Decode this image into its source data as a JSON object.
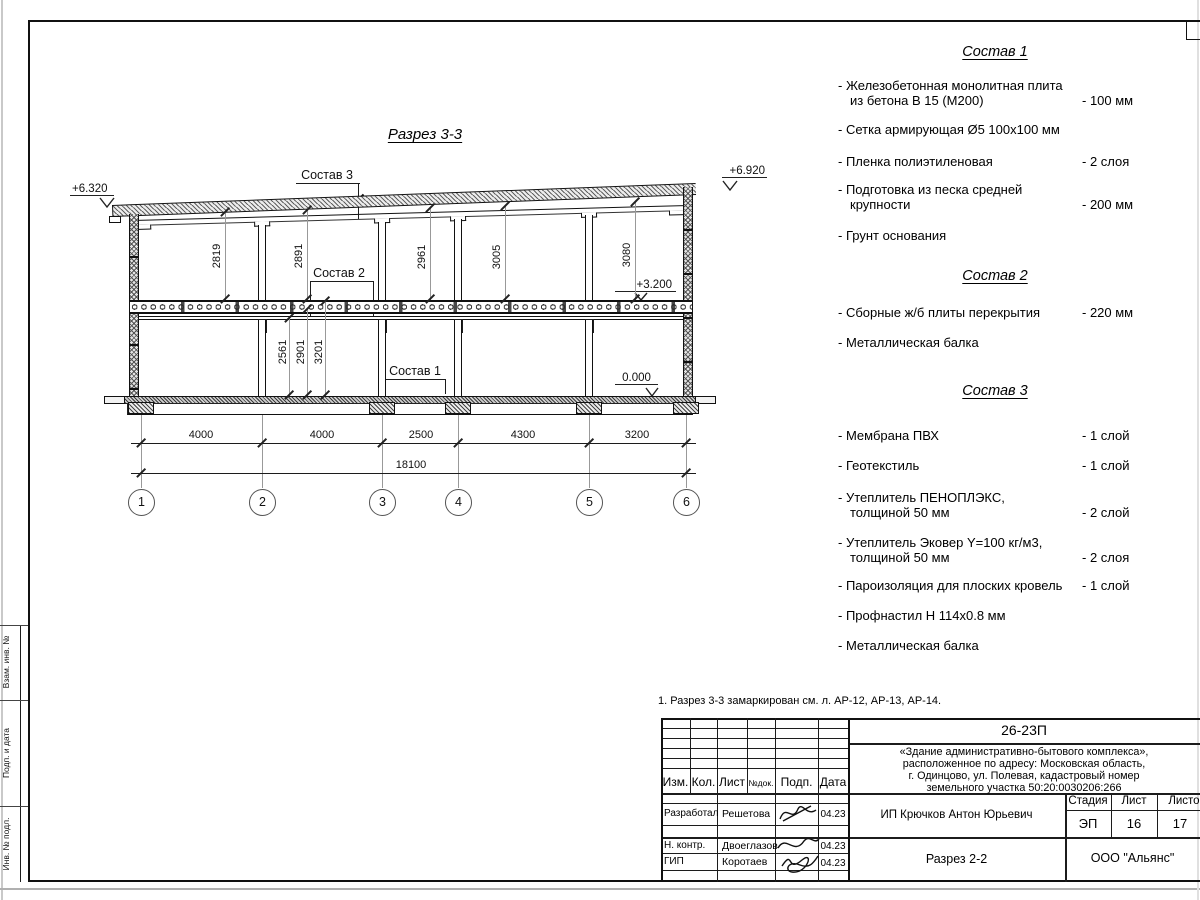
{
  "sheet": {
    "title": "Разрез 3-3",
    "note": "1. Разрез 3-3 замаркирован см. л. АР-12, АР-13, АР-14."
  },
  "section": {
    "elev_top_left": "+6.320",
    "elev_top_right": "+6.920",
    "elev_mid": "+3.200",
    "elev_zero": "0.000",
    "leader_sostav3": "Состав 3",
    "leader_sostav2": "Состав 2",
    "leader_sostav1": "Состав 1",
    "dims_upper": [
      "2819",
      "2891",
      "2961",
      "3005",
      "3080"
    ],
    "dims_lower": [
      "2561",
      "2901",
      "3201"
    ],
    "span_dims": [
      "4000",
      "4000",
      "2500",
      "4300",
      "3200"
    ],
    "total_dim": "18100",
    "axes": [
      "1",
      "2",
      "3",
      "4",
      "5",
      "6"
    ]
  },
  "specs": [
    {
      "title": "Состав 1",
      "items": [
        {
          "t1": "- Железобетонная  монолитная плита",
          "t2": "из бетона В 15 (М200)",
          "v": "- 100 мм"
        },
        {
          "t1": "- Сетка армирующая Ø5 100х100 мм"
        },
        {
          "t1": "- Пленка полиэтиленовая",
          "v": "-  2 слоя"
        },
        {
          "t1": "- Подготовка из песка средней",
          "t2": "крупности",
          "v": "- 200 мм"
        },
        {
          "t1": "- Грунт основания"
        }
      ]
    },
    {
      "title": "Состав 2",
      "items": [
        {
          "t1": "- Сборные ж/б плиты перекрытия",
          "v": "- 220 мм"
        },
        {
          "t1": "- Металлическая балка"
        }
      ]
    },
    {
      "title": "Состав 3",
      "items": [
        {
          "t1": "- Мембрана ПВХ",
          "v": "- 1 слой"
        },
        {
          "t1": "- Геотекстиль",
          "v": "- 1 слой"
        },
        {
          "t1": "- Утеплитель ПЕНОПЛЭКС,",
          "t2": "толщиной 50 мм",
          "v": "- 2 слой"
        },
        {
          "t1": "- Утеплитель Эковер Y=100 кг/м3,",
          "t2": "толщиной 50 мм",
          "v": "- 2 слоя"
        },
        {
          "t1": "- Пароизоляция для плоских кровель",
          "v": "- 1 слой"
        },
        {
          "t1": "- Профнастил Н 114х0.8 мм"
        },
        {
          "t1": "- Металлическая балка"
        }
      ]
    }
  ],
  "titleblock": {
    "doc_number": "26-23П",
    "project": [
      "«Здание административно-бытового комплекса»,",
      "расположенное по адресу: Московская область,",
      "г. Одинцово, ул. Полевая, кадастровый номер",
      "земельного участка 50:20:0030206:266"
    ],
    "header_cols": [
      "Изм.",
      "Кол.",
      "Лист",
      "№док.",
      "Подп.",
      "Дата"
    ],
    "rows": [
      {
        "role": "Разработал",
        "name": "Решетова",
        "date": "04.23"
      },
      {
        "role": "Н. контр.",
        "name": "Двоеглазов",
        "date": "04.23"
      },
      {
        "role": "ГИП",
        "name": "Коротаев",
        "date": "04.23"
      }
    ],
    "client": "ИП Крючков Антон Юрьевич",
    "stage_label": "Стадия",
    "sheet_label": "Лист",
    "sheets_label": "Листов",
    "stage": "ЭП",
    "sheet_no": "16",
    "sheets_total": "17",
    "drawing_name": "Разрез 2-2",
    "company": "ООО \"Альянс\""
  },
  "margin_stamps": [
    "Взам. инв. №",
    "Подп. и дата",
    "Инв. № подл."
  ]
}
